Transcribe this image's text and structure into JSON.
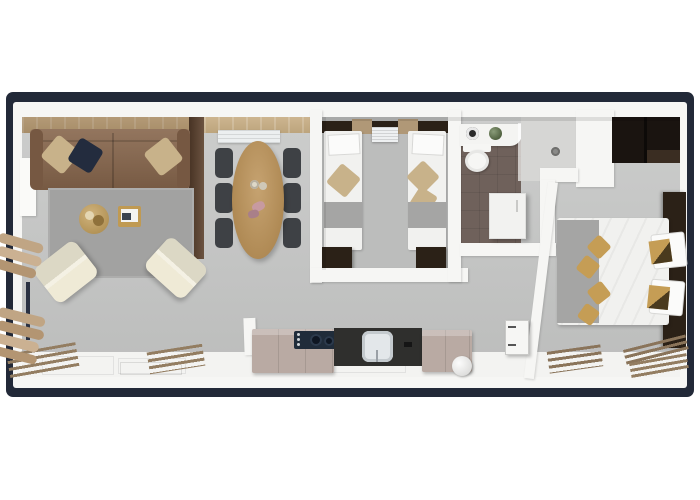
{
  "scene": {
    "type": "3d-floorplan-top-view",
    "rooms": [
      "living-room",
      "dining-area",
      "twin-bedroom",
      "bathroom",
      "shower",
      "hallway",
      "kitchen",
      "master-bedroom",
      "deck-strip"
    ],
    "furniture": [
      "sofa",
      "rug",
      "coffee-table",
      "magazine-table",
      "armchair",
      "dining-table",
      "dining-chair",
      "sideboard-ac",
      "twin-bed",
      "nightstand",
      "vanity",
      "toilet",
      "plant",
      "hall-cabinet",
      "door-leaf",
      "wardrobe",
      "double-bed",
      "kitchen-cabinet",
      "cooktop",
      "sink",
      "boiler-cylinder",
      "slat-bench",
      "lounger-stack",
      "railing"
    ]
  },
  "palette": {
    "frame_navy": "#222938",
    "wall_white": "#f6f6f4",
    "floor_main": "#c6c7c6",
    "floor_twin": "#bcbdbc",
    "floor_bath": "#6f615b",
    "floor_shower": "#d6d6d4",
    "deck_white": "#f3f3f1",
    "rug_gray": "#a2a2a1",
    "sofa_brown": "#87664c",
    "sofa_dark": "#765842",
    "wood_strip": "#c5ad85",
    "wood_dark_cabinet": "#5f4430",
    "table_wood": "#b98e51",
    "chair_dark": "#3e4145",
    "bed_white": "#f1f1ef",
    "pillow_white": "#fbfbfa",
    "runner_gray": "#a5a5a4",
    "pillow_beige": "#c8b28a",
    "pillow_navy": "#232c3e",
    "pillow_gold": "#c59d55",
    "headboard_dark": "#2b2117",
    "wardrobe_dark": "#1a1410",
    "wardrobe_shelf": "#3a2d22",
    "cabinet_taupe": "#b9aaa3",
    "counter_dark": "#2f2f2d",
    "cooktop_navy": "#202c3a",
    "sink_white": "#e3e7ea",
    "cream_chair": "#efead6",
    "lounger_beige": "#c0a584",
    "toilet_white": "#f6f6f4",
    "plant_green": "#57713f",
    "slat_wood": "#937d61",
    "gold_table": "#c09a52"
  }
}
